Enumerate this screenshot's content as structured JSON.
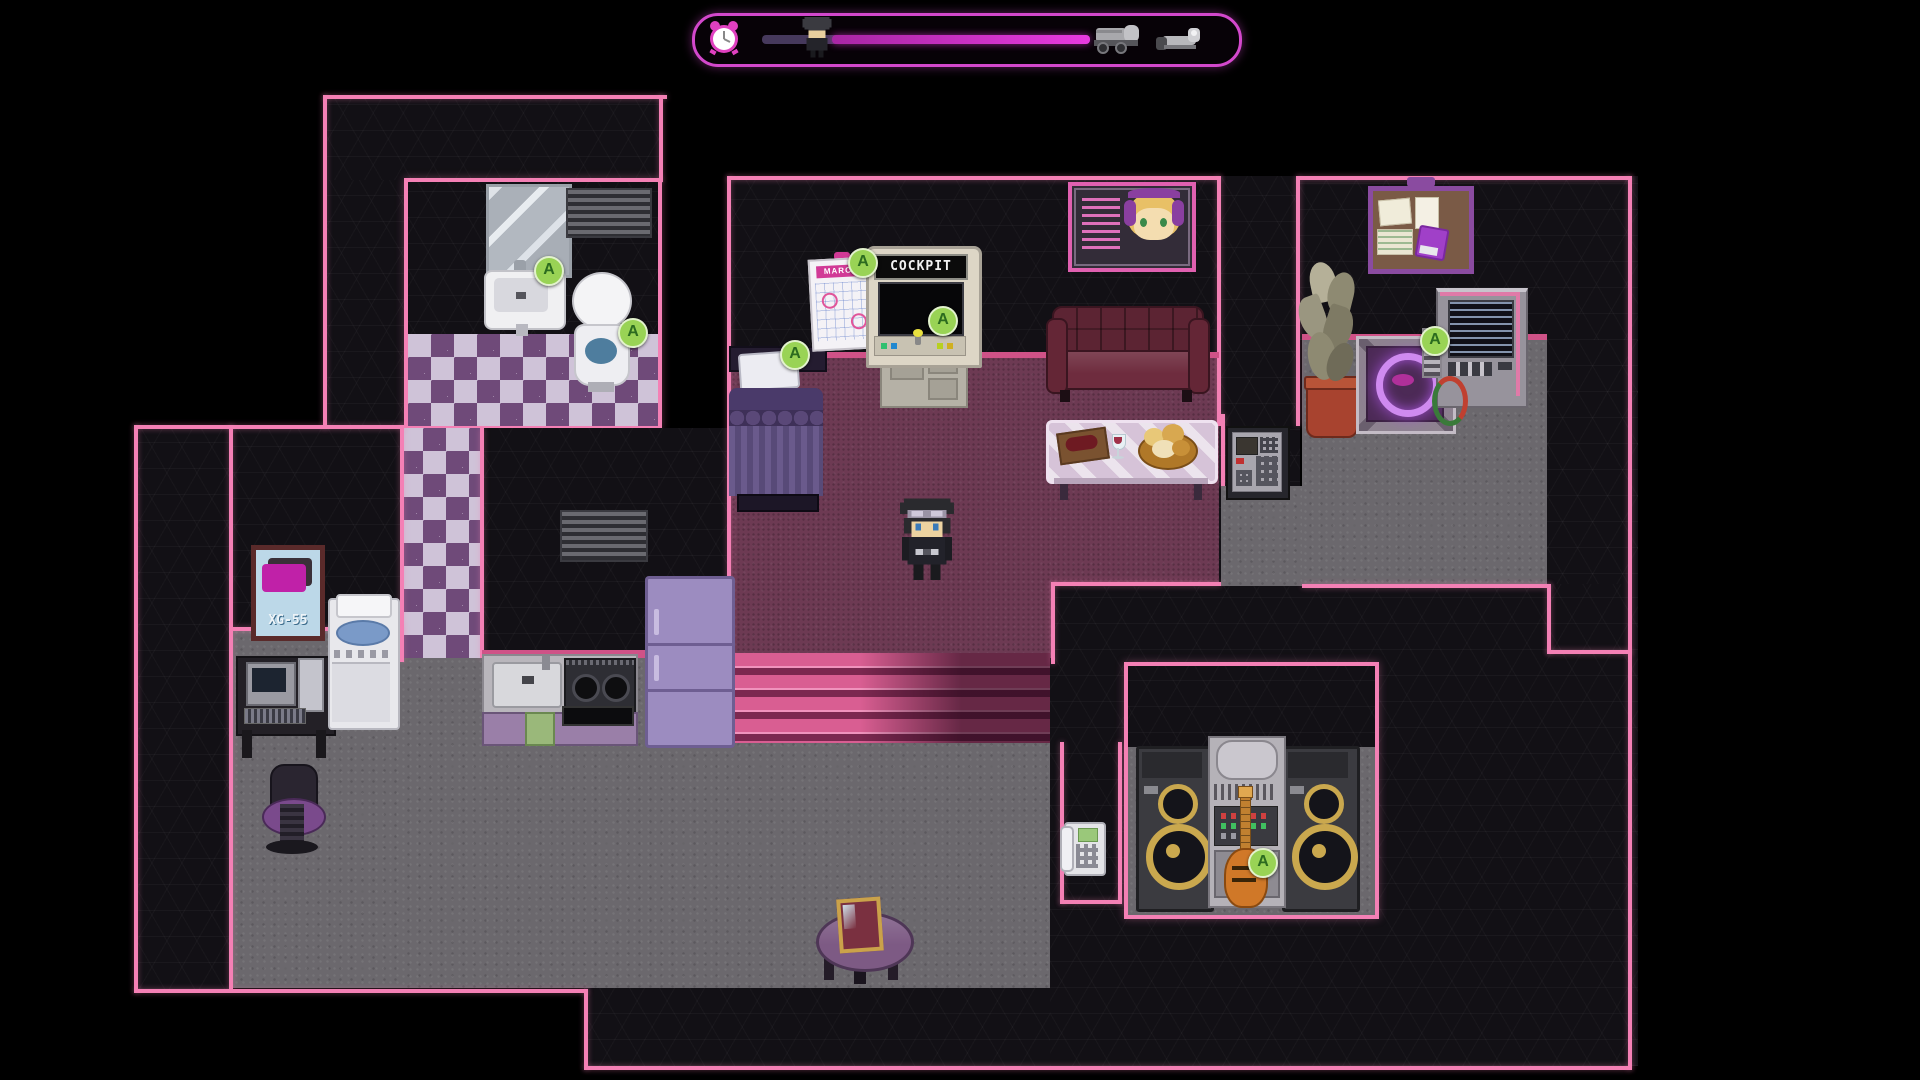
{
  "hud": {
    "timer_icon": "alarm-clock",
    "traveler_icon": "player-character-head",
    "destination_icons": [
      "delivery-truck",
      "scooter"
    ],
    "marker_position_percent": 21,
    "bar_colors": {
      "elapsed": "#46395c",
      "remaining": "#d42fd0"
    },
    "frame_color": "#d348cc"
  },
  "labels": {
    "cockpit_marquee": "COCKPIT",
    "calendar_month": "MARCH",
    "poster_caption": "XG-55",
    "interact_badge": "A"
  },
  "colors": {
    "outline_pink": "#f480b5",
    "trim_magenta": "#cf5287",
    "wall_dark": "#121015",
    "floor_gray": "#6b686d",
    "carpet": "#6d3a53",
    "checker_purple": "#6f4a79",
    "checker_light": "#cfc3d8",
    "stairs_pink": "#d95e92",
    "badge_green": "#99d355"
  },
  "rooms": {
    "bathroom": {
      "items": [
        "wall-mirror",
        "wall-vent",
        "sink",
        "toilet"
      ]
    },
    "bedroom_living": {
      "items": [
        "bed",
        "calendar",
        "cockpit-arcade-machine",
        "idol-poster",
        "couch",
        "glass-table",
        "wine-crate",
        "wine-glass",
        "bread-basket",
        "wall-keypad",
        "player-character"
      ]
    },
    "storage_room": {
      "items": [
        "bulletin-board",
        "potted-plant",
        "teleporter-pad",
        "terminal-machine"
      ]
    },
    "kitchen": {
      "items": [
        "washing-machine",
        "kitchen-sink",
        "gas-stove",
        "oven",
        "refrigerator",
        "cabinet-towel",
        "wall-vent"
      ]
    },
    "study": {
      "items": [
        "xg55-poster",
        "computer-desk",
        "monitor",
        "pc-tower",
        "office-chair"
      ]
    },
    "music_room": {
      "items": [
        "telephone",
        "speaker-left",
        "stereo-system",
        "speaker-right",
        "electric-guitar"
      ]
    },
    "hallway": {
      "items": [
        "round-table",
        "framed-photo",
        "stairs"
      ]
    }
  }
}
